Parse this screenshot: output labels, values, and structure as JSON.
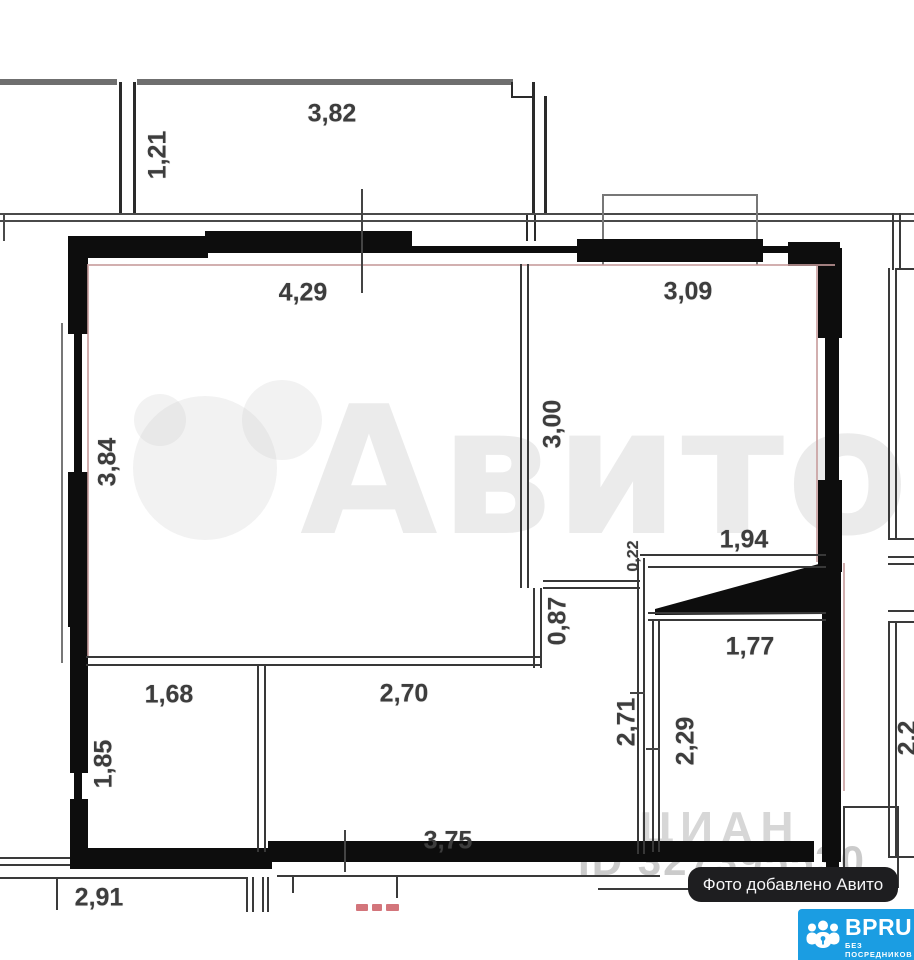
{
  "plan": {
    "labels": {
      "balcony_width": "3,82",
      "balcony_depth": "1,21",
      "living_width": "4,29",
      "bedroom_width": "3,09",
      "living_height": "3,84",
      "bedroom_height": "3,00",
      "niche_step": "0,22",
      "niche_width": "1,94",
      "wall_stub_height": "0,87",
      "bathroom_width": "1,77",
      "storage_width": "1,68",
      "hallway_width": "2,70",
      "hallway_height": "2,71",
      "bathroom_height": "2,29",
      "storage_height": "1,85",
      "bottom_width": "3,75",
      "neighbor_bottom_width": "2,91",
      "neighbor_right_partial": "2,2"
    }
  },
  "watermarks": {
    "brand": "Авито",
    "site": "ЦИАН",
    "listing_id": "ID 327395530"
  },
  "overlays": {
    "photo_badge": "Фото добавлено Авито",
    "logo_title": "BPRU",
    "logo_subtitle": "БЕЗ ПОСРЕДНИКОВ"
  },
  "colors": {
    "wall": "#0d0d0d",
    "thin_line": "#3a3a3a",
    "exterior_line": "#6f6f6f",
    "inner_face_pink": "#c79c9c",
    "badge_blue": "#1b9de2",
    "pill_black": "#1e1e20",
    "label_text": "#3d3d3d",
    "clipped_red": "#c4474f"
  }
}
